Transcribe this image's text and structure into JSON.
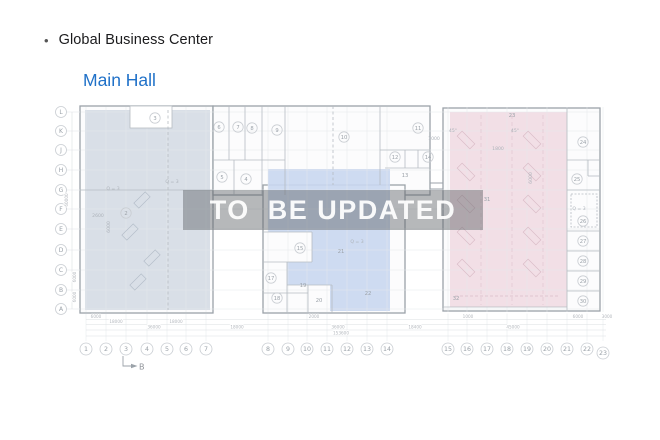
{
  "header": {
    "bullet": "•",
    "title": "Global Business Center",
    "subtitle": "Main Hall",
    "subtitle_color": "#2071c8"
  },
  "watermark": {
    "text": "TO  BE UPDATED"
  },
  "plan": {
    "colors": {
      "zone_left": "#d5dce4",
      "zone_middle": "#c9d7f0",
      "zone_right": "#f1dce3",
      "wall": "#9ba2a9",
      "inner_wall": "#b6bcc2",
      "grid": "#e5e8eb",
      "bubble_stroke": "#c9cdd2",
      "label": "#9aa1a8",
      "dim": "#b4b8be",
      "anno": "#adb3ba"
    },
    "row_axis": {
      "x": 61,
      "items": [
        {
          "label": "L",
          "y": 112
        },
        {
          "label": "K",
          "y": 131
        },
        {
          "label": "J",
          "y": 150
        },
        {
          "label": "H",
          "y": 170
        },
        {
          "label": "G",
          "y": 190
        },
        {
          "label": "F",
          "y": 209
        },
        {
          "label": "E",
          "y": 229
        },
        {
          "label": "D",
          "y": 250
        },
        {
          "label": "C",
          "y": 270
        },
        {
          "label": "B",
          "y": 290
        },
        {
          "label": "A",
          "y": 309
        }
      ]
    },
    "col_axis": [
      {
        "label": "1",
        "x": 86,
        "y": 349
      },
      {
        "label": "2",
        "x": 106,
        "y": 349
      },
      {
        "label": "3",
        "x": 126,
        "y": 349
      },
      {
        "label": "4",
        "x": 147,
        "y": 349
      },
      {
        "label": "5",
        "x": 167,
        "y": 349
      },
      {
        "label": "6",
        "x": 186,
        "y": 349
      },
      {
        "label": "7",
        "x": 206,
        "y": 349
      },
      {
        "label": "8",
        "x": 268,
        "y": 349
      },
      {
        "label": "9",
        "x": 288,
        "y": 349
      },
      {
        "label": "10",
        "x": 307,
        "y": 349
      },
      {
        "label": "11",
        "x": 327,
        "y": 349
      },
      {
        "label": "12",
        "x": 347,
        "y": 349
      },
      {
        "label": "13",
        "x": 367,
        "y": 349
      },
      {
        "label": "14",
        "x": 387,
        "y": 349
      },
      {
        "label": "15",
        "x": 448,
        "y": 349
      },
      {
        "label": "16",
        "x": 467,
        "y": 349
      },
      {
        "label": "17",
        "x": 487,
        "y": 349
      },
      {
        "label": "18",
        "x": 507,
        "y": 349
      },
      {
        "label": "19",
        "x": 527,
        "y": 349
      },
      {
        "label": "20",
        "x": 547,
        "y": 349
      },
      {
        "label": "21",
        "x": 567,
        "y": 349
      },
      {
        "label": "22",
        "x": 587,
        "y": 349
      },
      {
        "label": "23",
        "x": 603,
        "y": 353
      }
    ],
    "rooms": [
      {
        "n": "3",
        "x": 155,
        "y": 118,
        "c": true
      },
      {
        "n": "6",
        "x": 219,
        "y": 127,
        "c": true
      },
      {
        "n": "7",
        "x": 238,
        "y": 127,
        "c": true
      },
      {
        "n": "8",
        "x": 252,
        "y": 128,
        "c": true
      },
      {
        "n": "9",
        "x": 277,
        "y": 130,
        "c": true
      },
      {
        "n": "10",
        "x": 344,
        "y": 137,
        "c": true
      },
      {
        "n": "11",
        "x": 418,
        "y": 128,
        "c": true
      },
      {
        "n": "12",
        "x": 395,
        "y": 157,
        "c": true
      },
      {
        "n": "14",
        "x": 428,
        "y": 157,
        "c": true
      },
      {
        "n": "13",
        "x": 405,
        "y": 175,
        "c": false
      },
      {
        "n": "5",
        "x": 222,
        "y": 177,
        "c": true
      },
      {
        "n": "4",
        "x": 246,
        "y": 179,
        "c": true
      },
      {
        "n": "2",
        "x": 126,
        "y": 213,
        "c": true
      },
      {
        "n": "15",
        "x": 300,
        "y": 248,
        "c": true
      },
      {
        "n": "17",
        "x": 271,
        "y": 278,
        "c": true
      },
      {
        "n": "18",
        "x": 277,
        "y": 298,
        "c": true
      },
      {
        "n": "19",
        "x": 303,
        "y": 285,
        "c": false
      },
      {
        "n": "20",
        "x": 319,
        "y": 300,
        "c": false
      },
      {
        "n": "21",
        "x": 341,
        "y": 251,
        "c": false
      },
      {
        "n": "22",
        "x": 368,
        "y": 293,
        "c": false
      },
      {
        "n": "23",
        "x": 512,
        "y": 115,
        "c": false
      },
      {
        "n": "31",
        "x": 487,
        "y": 199,
        "c": false
      },
      {
        "n": "32",
        "x": 456,
        "y": 298,
        "c": false
      },
      {
        "n": "24",
        "x": 583,
        "y": 142,
        "c": true
      },
      {
        "n": "25",
        "x": 577,
        "y": 179,
        "c": true
      },
      {
        "n": "26",
        "x": 583,
        "y": 221,
        "c": true
      },
      {
        "n": "27",
        "x": 583,
        "y": 241,
        "c": true
      },
      {
        "n": "28",
        "x": 583,
        "y": 261,
        "c": true
      },
      {
        "n": "29",
        "x": 583,
        "y": 281,
        "c": true
      },
      {
        "n": "30",
        "x": 583,
        "y": 301,
        "c": true
      }
    ],
    "annotations": [
      {
        "t": "Q = 3",
        "x": 113,
        "y": 190
      },
      {
        "t": "Q = 3",
        "x": 172,
        "y": 183
      },
      {
        "t": "Q = 3",
        "x": 357,
        "y": 243
      },
      {
        "t": "Q = 3",
        "x": 579,
        "y": 210
      },
      {
        "t": "2600",
        "x": 98,
        "y": 217
      },
      {
        "t": "1800",
        "x": 498,
        "y": 150
      },
      {
        "t": "45°",
        "x": 453,
        "y": 132
      },
      {
        "t": "45°",
        "x": 515,
        "y": 132
      },
      {
        "t": "1000",
        "x": 434,
        "y": 140
      },
      {
        "t": "6000",
        "x": 110,
        "y": 227,
        "rot": 1
      },
      {
        "t": "6000",
        "x": 532,
        "y": 178,
        "rot": 1
      }
    ],
    "dims_bottom": [
      {
        "t": "6000",
        "x": 96,
        "y": 318
      },
      {
        "t": "2000",
        "x": 314,
        "y": 318
      },
      {
        "t": "1000",
        "x": 468,
        "y": 318
      },
      {
        "t": "6000",
        "x": 578,
        "y": 318
      },
      {
        "t": "3000",
        "x": 607,
        "y": 318
      },
      {
        "t": "18000",
        "x": 116,
        "y": 323
      },
      {
        "t": "18000",
        "x": 176,
        "y": 323
      },
      {
        "t": "36000",
        "x": 154,
        "y": 328.5
      },
      {
        "t": "18000",
        "x": 237,
        "y": 328.5
      },
      {
        "t": "36000",
        "x": 338,
        "y": 328.5
      },
      {
        "t": "18400",
        "x": 415,
        "y": 328.5
      },
      {
        "t": "45000",
        "x": 513,
        "y": 328.5
      },
      {
        "t": "153600",
        "x": 341,
        "y": 334.5
      }
    ],
    "dims_left": [
      {
        "t": "60000",
        "x": 68,
        "y": 200,
        "rot": 1
      },
      {
        "t": "6000",
        "x": 76,
        "y": 277,
        "rot": 1
      },
      {
        "t": "6000",
        "x": 76,
        "y": 297,
        "rot": 1
      }
    ],
    "section_marker": {
      "label": "B"
    }
  }
}
